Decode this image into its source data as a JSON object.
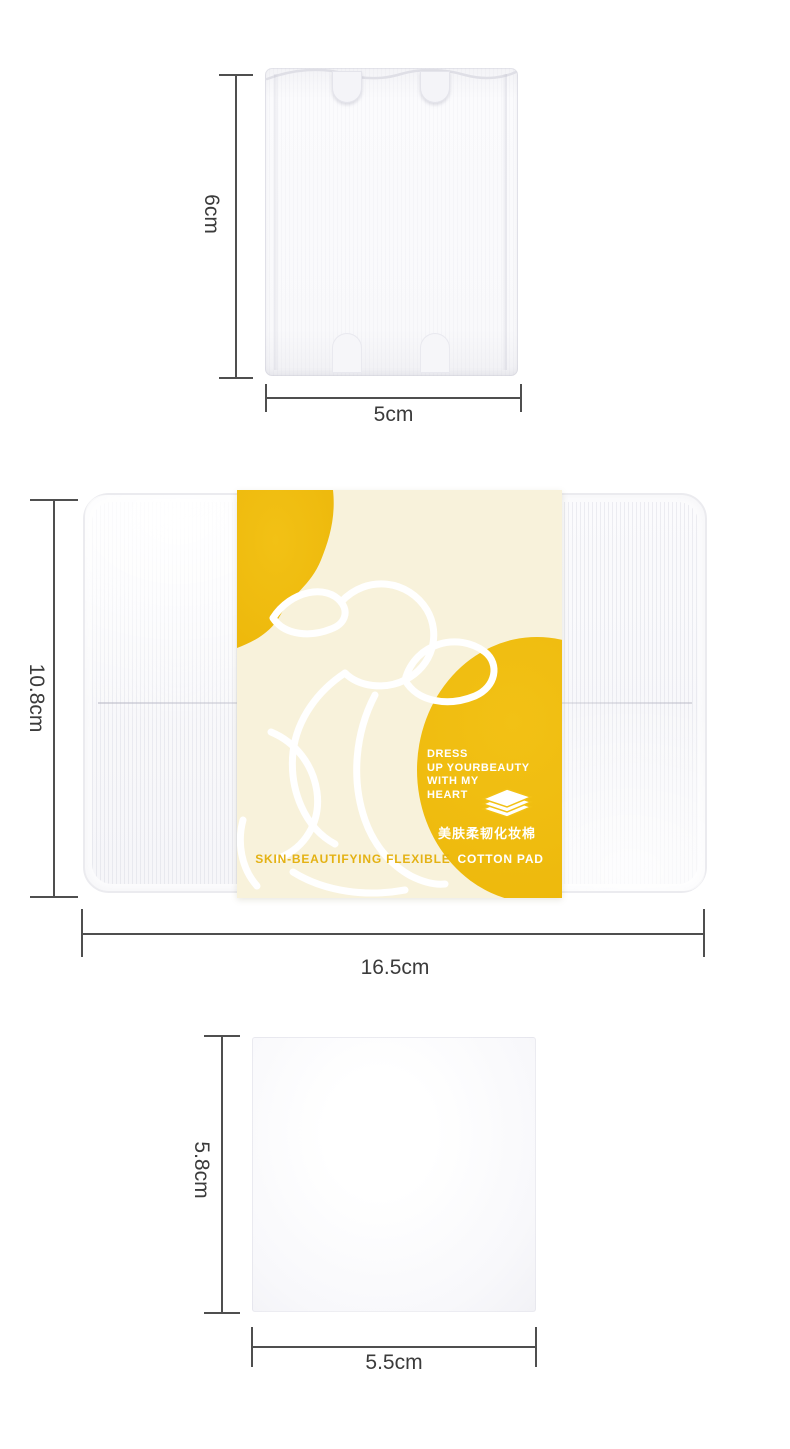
{
  "title": "cotton pad size specification image",
  "colors": {
    "yellow": "#f2c115",
    "yellow-deep": "#edb80b",
    "cream": "#f8f2db",
    "gold-text": "#e4b214",
    "dim-line": "#4f4f4f",
    "dim-text": "#3b3b3b"
  },
  "sections": {
    "top_pad": {
      "height": "6cm",
      "width": "5cm"
    },
    "package": {
      "height": "10.8cm",
      "width": "16.5cm",
      "band": {
        "slogan_lines": [
          "DRESS",
          "UP YOURBEAUTY",
          "WITH MY",
          "HEART"
        ],
        "chinese_name": "美肤柔韧化妆棉",
        "tagline_gold": "SKIN-BEAUTIFYING FLEXIBLE",
        "tagline_white": "COTTON PAD"
      }
    },
    "bottom_pad": {
      "height": "5.8cm",
      "width": "5.5cm"
    }
  }
}
